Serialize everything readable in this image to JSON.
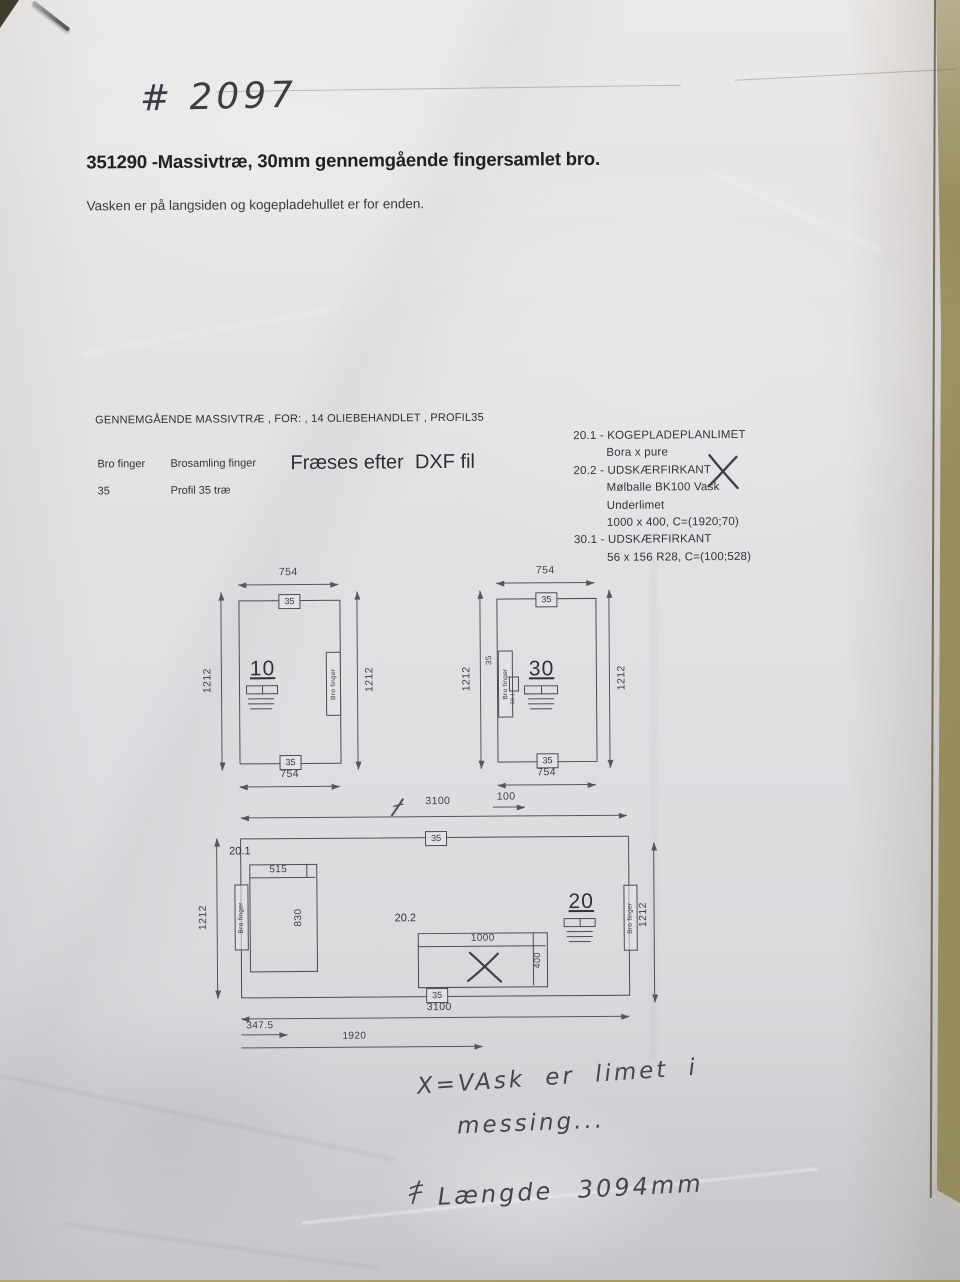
{
  "page": {
    "handwritten_number": "# 2097",
    "title": "351290 -Massivtræ, 30mm gennemgående fingersamlet bro.",
    "subtitle": "Vasken er på langsiden og kogepladehullet er for enden.",
    "spec_line": "GENNEMGÅENDE MASSIVTRÆ , FOR: , 14 OLIEBEHANDLET , PROFIL35",
    "dxf_note": "Fræses efter  DXF fil"
  },
  "legend": {
    "col1_header": "Bro finger",
    "col1_value": "35",
    "col2_header": "Brosamling finger",
    "col2_value": "Profil 35 træ"
  },
  "operations": [
    {
      "code": "20.1 -",
      "title": "KOGEPLADEPLANLIMET",
      "detail1": "Bora x pure"
    },
    {
      "code": "20.2 -",
      "title": "UDSKÆRFIRKANT",
      "detail1": "Mølballe BK100 Vask",
      "detail2": "Underlimet",
      "detail3": "1000 x 400, C=(1920;70)"
    },
    {
      "code": "30.1 -",
      "title": "UDSKÆRFIRKANT",
      "detail1": "56 x 156 R28, C=(100;528)"
    }
  ],
  "drawing_left": {
    "part": "10",
    "dim_top": "754",
    "dim_bottom": "754",
    "dim_left": "1212",
    "dim_right": "1212",
    "edge_top": "35",
    "edge_bottom": "35",
    "edge_label": "Bro finger"
  },
  "drawing_right": {
    "part": "30",
    "dim_top": "754",
    "dim_bottom": "754",
    "dim_left": "1212",
    "dim_right": "1212",
    "edge_top": "35",
    "edge_bottom": "35",
    "edge_label": "Bro finger",
    "edge_mark": "35",
    "cutout_ref": "30.1",
    "dim_offset": "100"
  },
  "drawing_main": {
    "part": "20",
    "dim_top": "3100",
    "dim_bottom": "3100",
    "dim_left": "1212",
    "dim_right": "1212",
    "edge_top": "35",
    "edge_bottom": "35",
    "ref_hob": "20.1",
    "hob_width": "515",
    "hob_depth": "830",
    "ref_sink": "20.2",
    "sink_width": "1000",
    "sink_depth": "400",
    "dim_left_offset": "347.5",
    "dim_sink_pos": "1920",
    "edge_label_left": "Bro finger",
    "edge_label_right": "Bro finger"
  },
  "notes": {
    "sink_line1": "X=VAsk er limet i",
    "sink_line2": "messing...",
    "length_note": "Længde 3094mm"
  },
  "colors": {
    "paper": "#e0dee1",
    "desk": "#a89d66",
    "ink": "#333338",
    "pencil": "#44464f"
  }
}
